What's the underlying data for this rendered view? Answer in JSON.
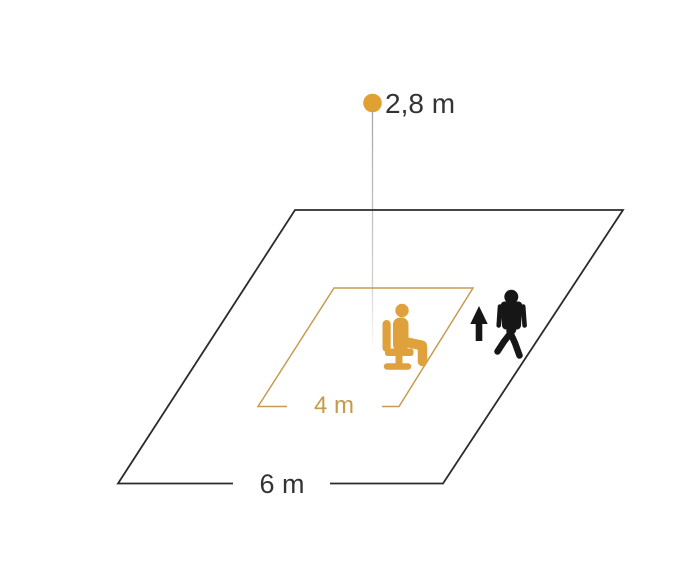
{
  "diagram": {
    "labels": {
      "mounting_height": "2,8 m",
      "seated_detection_range": "4 m",
      "walking_detection_range": "6 m"
    },
    "colors": {
      "accent_orange": "#E1A033",
      "icon_orange": "#DFA13C",
      "line_tan": "#C79C52",
      "label_tan": "#C6994B",
      "ink": "#333333",
      "line_black": "#2B2B2B",
      "icon_black": "#161616"
    },
    "icons": {
      "sensor": "sensor-dot",
      "seated": "seated-person-icon",
      "walking": "walking-person-icon",
      "arrow": "up-arrow-icon"
    }
  }
}
